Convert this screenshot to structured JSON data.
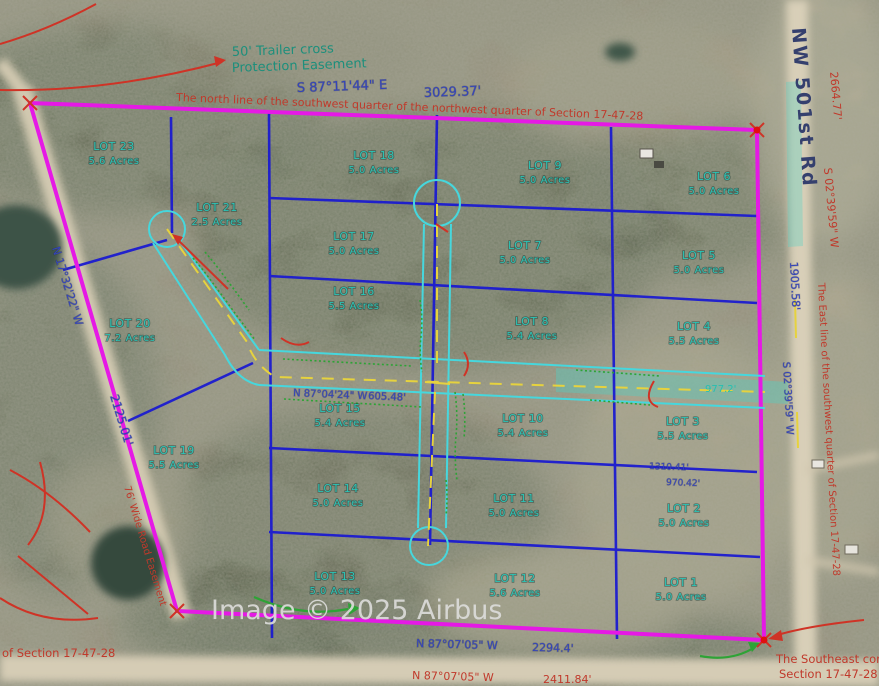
{
  "watermark": "Image © 2025 Airbus",
  "road": {
    "name": "NW 501st Rd"
  },
  "notes": {
    "easement1": "50' Trailer cross",
    "easement2": "Protection Easement",
    "north_line": "The north line of the southwest quarter of the northwest quarter of Section 17-47-28",
    "east_line": "The East line of the southwest quarter of Section 17-47-28",
    "se1": "The Southeast corner",
    "se2": "Section 17-47-28",
    "sw": "of Section 17-47-28",
    "road_easement": "76' Wide Road Easement"
  },
  "bearings": {
    "top_bearing": "S 87°11'44\" E",
    "top_distance": "3029.37'",
    "right_outer_distance": "2664.77'",
    "right_outer_bearing": "S 02°39'59\" W",
    "right_inner_distance": "1905.58'",
    "right_inner_bearing": "S 02°39'59\" W",
    "bottom_inner_bearing": "N 87°07'05\" W",
    "bottom_inner_distance": "2294.4'",
    "bottom_outer_bearing": "N 87°07'05\" W",
    "bottom_outer_distance": "2411.84'",
    "west_bearing": "N 17°32'22\" W",
    "west_distance": "2125.01'",
    "road_bearing": "N 87°04'24\" W",
    "road_distance": "605.48'",
    "frontage": "977.2'",
    "dim1": "1310.41'",
    "dim2": "970.42'"
  },
  "lots": [
    {
      "name": "LOT 1",
      "acres": "5.0 Acres"
    },
    {
      "name": "LOT 2",
      "acres": "5.0 Acres"
    },
    {
      "name": "LOT 3",
      "acres": "5.5 Acres"
    },
    {
      "name": "LOT 4",
      "acres": "5.5 Acres"
    },
    {
      "name": "LOT 5",
      "acres": "5.0 Acres"
    },
    {
      "name": "LOT 6",
      "acres": "5.0 Acres"
    },
    {
      "name": "LOT 7",
      "acres": "5.0 Acres"
    },
    {
      "name": "LOT 8",
      "acres": "5.4 Acres"
    },
    {
      "name": "LOT 9",
      "acres": "5.0 Acres"
    },
    {
      "name": "LOT 10",
      "acres": "5.4 Acres"
    },
    {
      "name": "LOT 11",
      "acres": "5.0 Acres"
    },
    {
      "name": "LOT 12",
      "acres": "5.6 Acres"
    },
    {
      "name": "LOT 13",
      "acres": "5.0 Acres"
    },
    {
      "name": "LOT 14",
      "acres": "5.0 Acres"
    },
    {
      "name": "LOT 15",
      "acres": "5.4 Acres"
    },
    {
      "name": "LOT 16",
      "acres": "5.5 Acres"
    },
    {
      "name": "LOT 17",
      "acres": "5.0 Acres"
    },
    {
      "name": "LOT 18",
      "acres": "5.0 Acres"
    },
    {
      "name": "LOT 19",
      "acres": "5.5 Acres"
    },
    {
      "name": "LOT 20",
      "acres": "7.2 Acres"
    },
    {
      "name": "LOT 21",
      "acres": "2.5 Acres"
    },
    {
      "name": "LOT 23",
      "acres": "5.6 Acres"
    }
  ]
}
